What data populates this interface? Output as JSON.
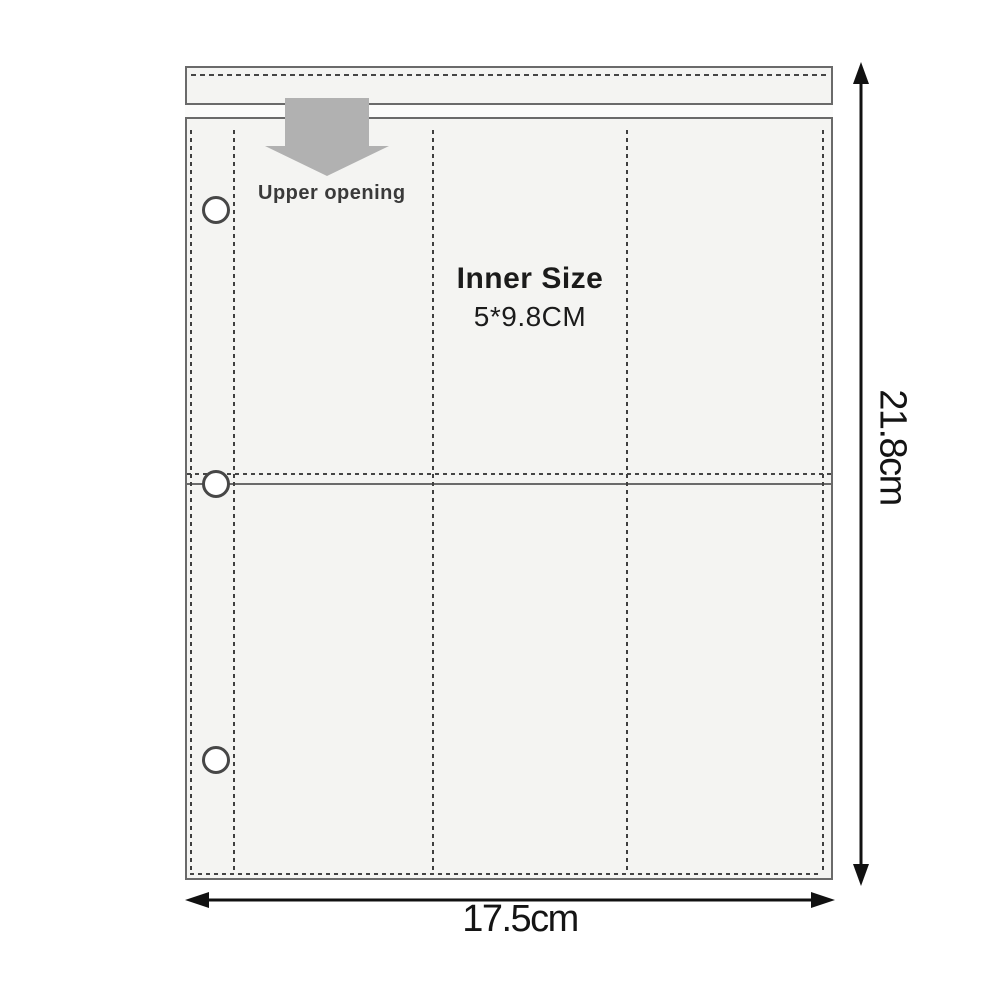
{
  "labels": {
    "upper_opening": "Upper opening",
    "inner_size_title": "Inner Size",
    "inner_size_value": "5*9.8CM",
    "height_dimension": "21.8cm",
    "width_dimension": "17.5cm"
  },
  "structure": {
    "pocket_rows": 2,
    "pocket_columns": 3,
    "binder_holes": 3,
    "opening_side": "top"
  },
  "colors": {
    "background": "#ffffff",
    "sleeve_fill": "#f4f4f2",
    "band_fill": "#fbfbfa",
    "outline": "#6a6a6a",
    "stitch": "#3f3f3f",
    "opening_arrow": "#b1b1b1",
    "label_text": "#3a3a3a",
    "dimension_text": "#141414"
  }
}
